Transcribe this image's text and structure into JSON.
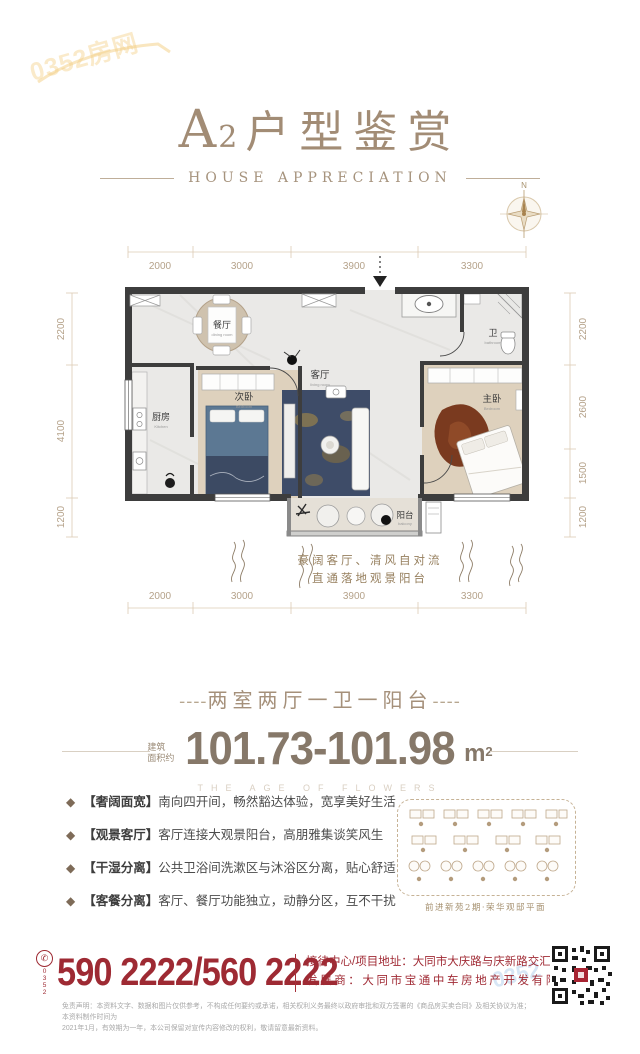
{
  "colors": {
    "accent_red": "#9e2a33",
    "title_tan": "#a28c75",
    "wall": "#3d3d3d"
  },
  "watermark": {
    "text": "0352房网",
    "text_small": "0352"
  },
  "header": {
    "title_a": "A",
    "title_num": "2",
    "title_cjk": "户型鉴赏",
    "subtitle": "HOUSE APPRECIATION"
  },
  "compass": {
    "north": "N"
  },
  "floorplan": {
    "dims_h": [
      "2000",
      "3000",
      "3900",
      "3300"
    ],
    "dims_left": [
      "2200",
      "4100",
      "1200"
    ],
    "dims_right": [
      "2200",
      "2600",
      "1500",
      "1200"
    ],
    "rooms": {
      "dining": "餐厅",
      "kitchen": "厨房",
      "bedroom2": "次卧",
      "living": "客厅",
      "bath": "卫",
      "master": "主卧",
      "balcony": "阳台"
    },
    "rooms_en": {
      "dining": "dining room",
      "kitchen": "Kitchen",
      "bedroom2": "Bedroom",
      "living": "living room",
      "bath": "bathroom",
      "master": "Bedroom",
      "balcony": "balcony"
    },
    "caption_line1": "豪阔客厅、清风自对流",
    "caption_line2": "直通落地观景阳台"
  },
  "summary": {
    "dash": "----",
    "layout_line": "两室两厅一卫一阳台",
    "area_prefix_1": "建筑",
    "area_prefix_2": "面积约",
    "area_value": "101.73-101.98",
    "area_unit": "m",
    "area_sup": "2",
    "tagline": "THE AGE OF FLOWERS"
  },
  "features": [
    {
      "tag": "【奢阔面宽】",
      "text": "南向四开间，畅然豁达体验，宽享美好生活"
    },
    {
      "tag": "【观景客厅】",
      "text": "客厅连接大观景阳台，高朋雅集谈笑风生"
    },
    {
      "tag": "【干湿分离】",
      "text": "公共卫浴间洗漱区与沐浴区分离，贴心舒适"
    },
    {
      "tag": "【客餐分离】",
      "text": "客厅、餐厅功能独立，动静分区，互不干扰"
    }
  ],
  "siteplan": {
    "caption": "前进新苑2期·荣华观邸平面"
  },
  "contact": {
    "area_code": "0352",
    "phone": "590 2222/560 2222",
    "line1": "接待中心/项目地址：大同市大庆路与庆新路交汇处",
    "line2": "发展商：大同市宝通中车房地产开发有限公司"
  },
  "legal": {
    "line1": "免责声明：本资料文字、数据和图片仅供参考，不构成任何要约或承诺，相关权利义务最终以政府审批和双方签署的《商品房买卖合同》及相关协议为准；本资料制作时间为",
    "line2": "2021年1月，有效期为一年，本公司保留对宣传内容修改的权利，敬请留意最新资料。"
  }
}
